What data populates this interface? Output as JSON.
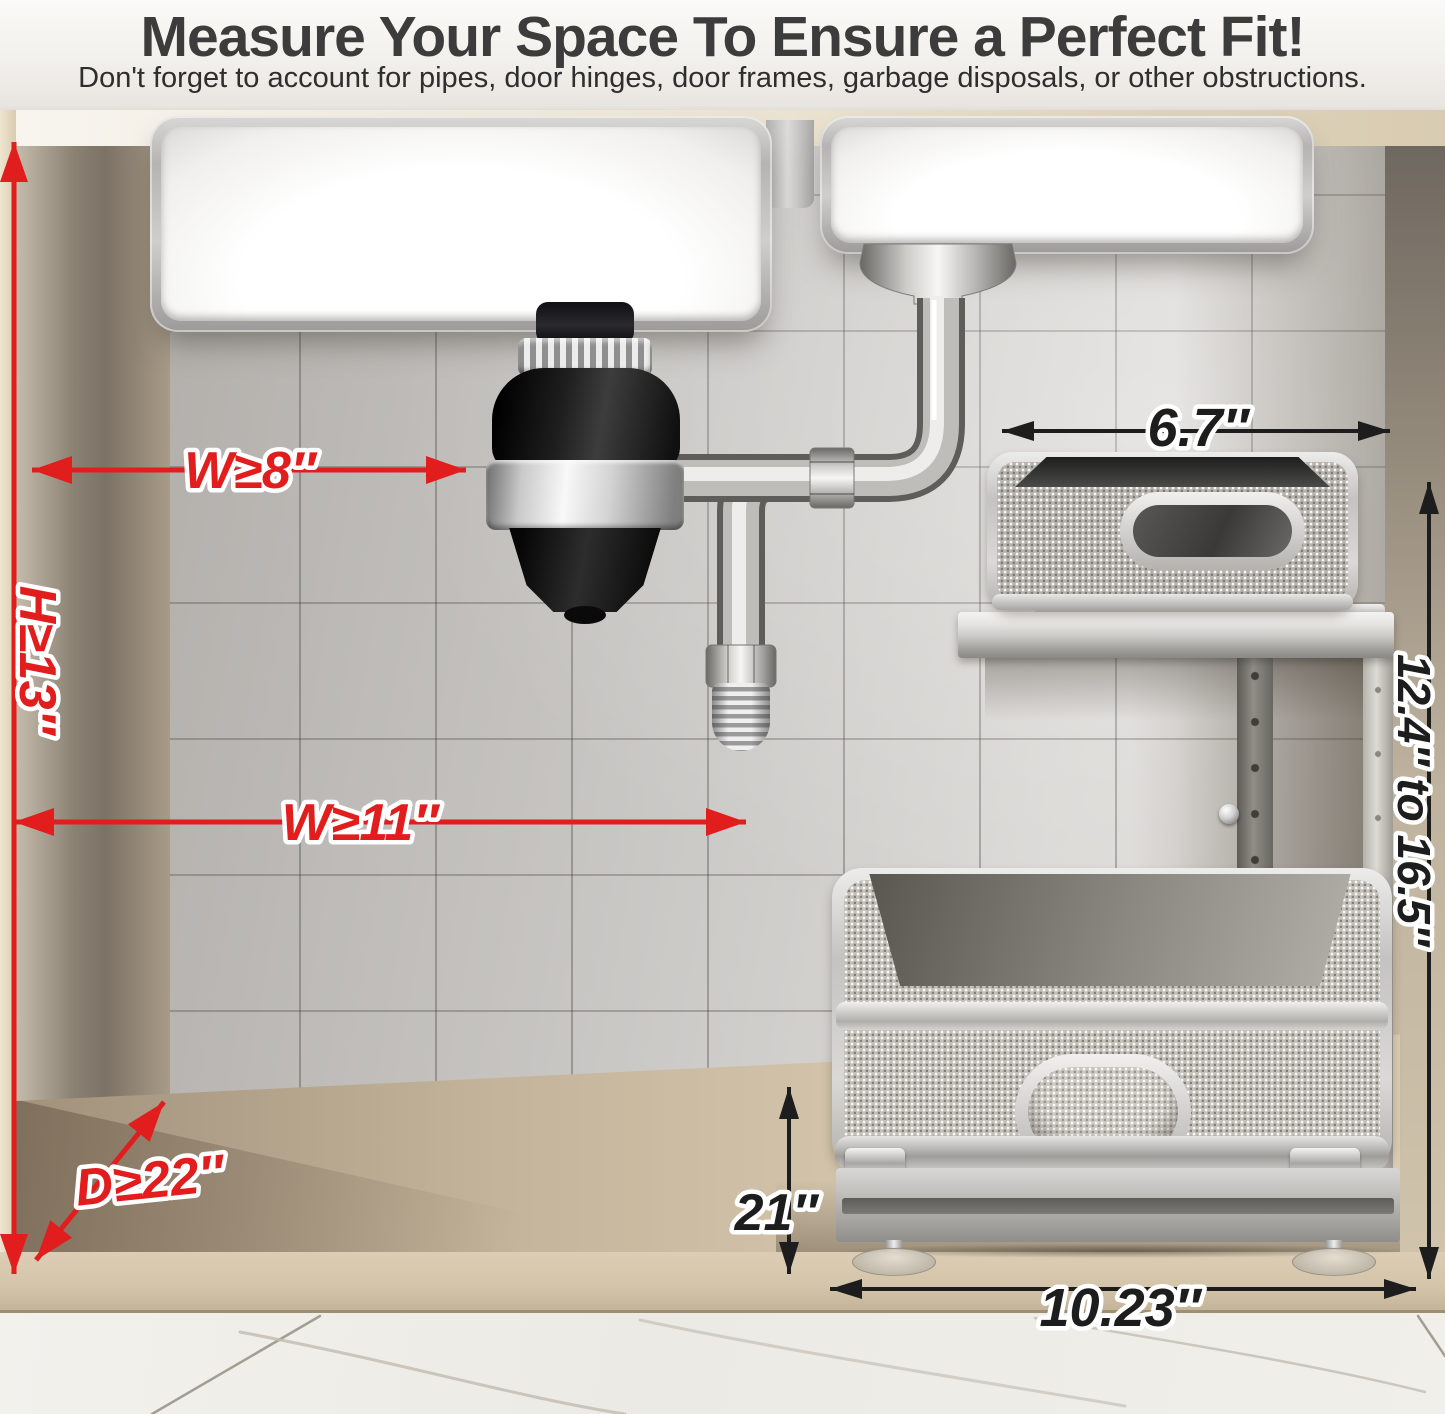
{
  "header": {
    "title": "Measure Your Space To Ensure a Perfect Fit!",
    "subtitle": "Don't forget to account for pipes, door hinges, door frames, garbage disposals, or other obstructions."
  },
  "measurements": {
    "disposal_side_width": "W≥8″",
    "cabinet_height": "H≥13″",
    "lower_clearance_width": "W≥11″",
    "cabinet_depth": "D≥22″",
    "upper_basket_width": "6.7″",
    "adjustable_height_range": "12.4″ to 16.5″",
    "pullout_length": "21″",
    "base_width": "10.23″"
  },
  "colors": {
    "annotation_red": "#e11d1d",
    "annotation_black": "#1d1d1d"
  }
}
